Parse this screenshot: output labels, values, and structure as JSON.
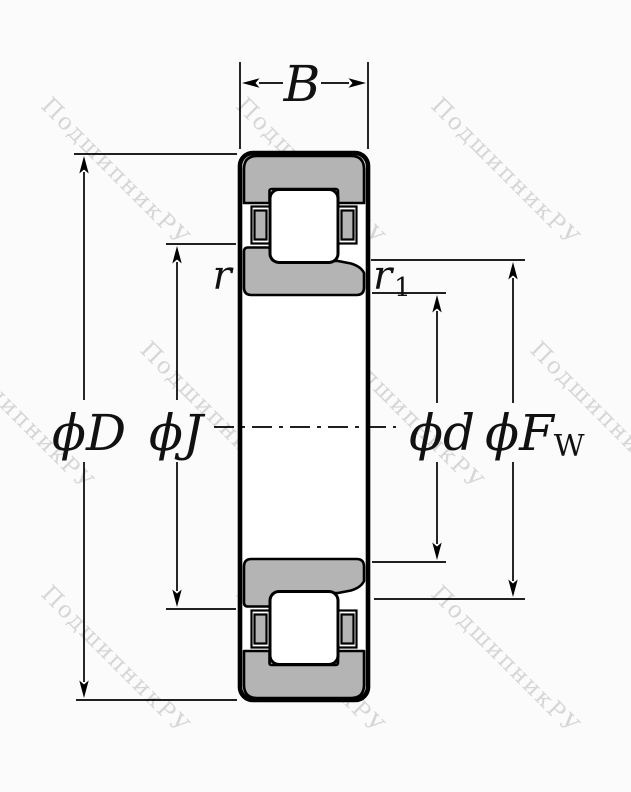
{
  "diagram": {
    "type": "cylindrical-roller-bearing-cross-section",
    "watermark": {
      "text": "ПодшипникРУ",
      "color": "#d2d2d2"
    },
    "colors": {
      "ring_fill": "#b4b4b4",
      "line": "#000000"
    },
    "dimensions": {
      "width": {
        "label": "B"
      },
      "outer_diameter": {
        "label": "ϕD"
      },
      "rib_diameter": {
        "label": "ϕJ"
      },
      "bore_diameter": {
        "label": "ϕd"
      },
      "raceway_diameter": {
        "label": "ϕF",
        "subscript": "W"
      },
      "outer_chamfer": {
        "label": "r"
      },
      "inner_chamfer": {
        "label": "r",
        "subscript": "1"
      }
    }
  }
}
